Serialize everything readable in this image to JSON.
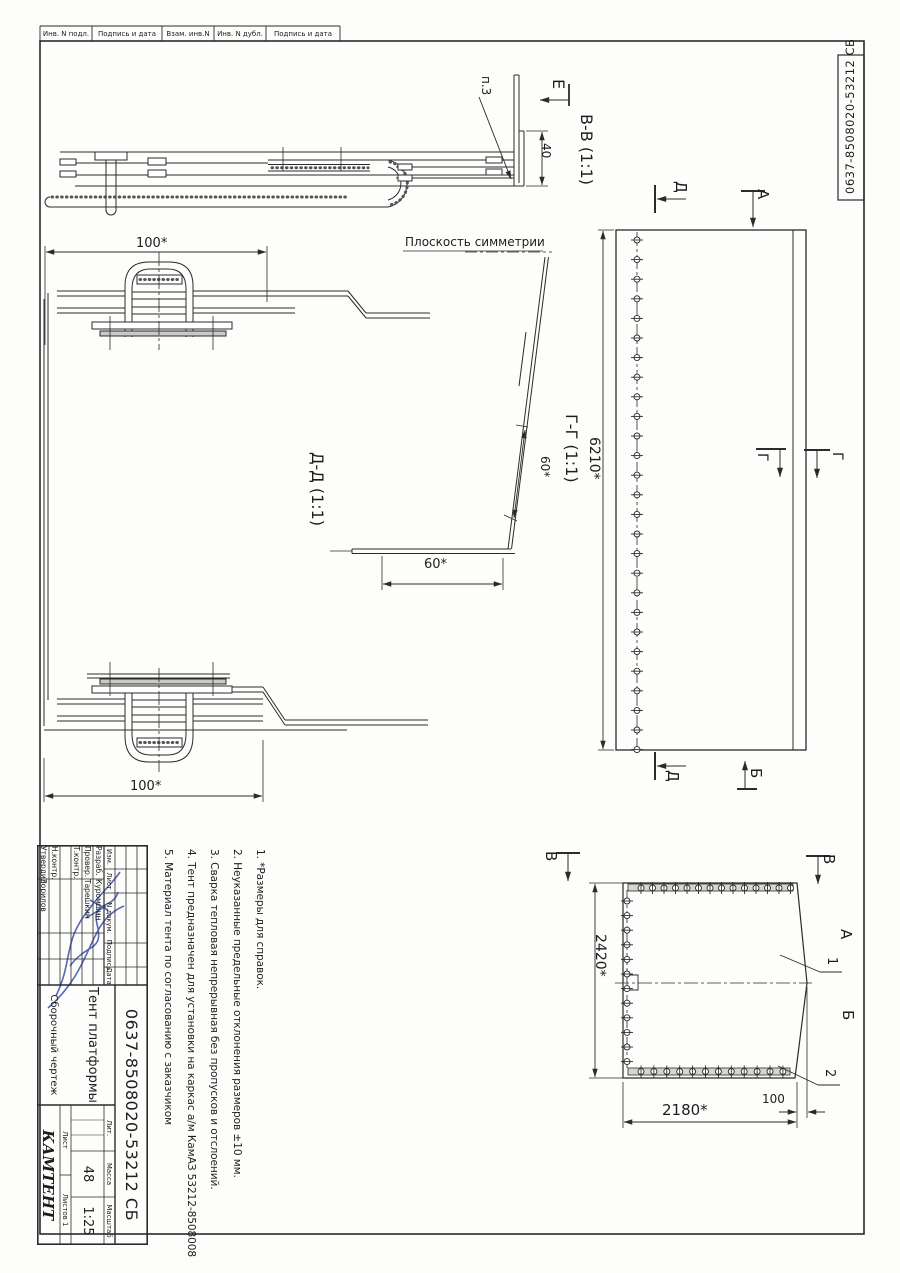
{
  "filing_strip": {
    "cells": [
      "Инв. N подл.",
      "Подпись и дата",
      "Взам. инв.N",
      "Инв. N дубл.",
      "Подпись и дата"
    ]
  },
  "corner_stamp": {
    "doc_number": "0637-8508020-53212  СБ"
  },
  "labels": {
    "symmetry": "Плоскость симметрии",
    "p3": "п.3",
    "bb": "В-В  (1:1)",
    "gg": "Г-Г  (1:1)",
    "dd": "Д-Д  (1:1)"
  },
  "dims": {
    "d40": "40",
    "d100_top": "100*",
    "d100_bot": "100*",
    "d60_g": "60*",
    "d60_d": "60*",
    "d6210": "6210*",
    "d2420": "2420*",
    "d2180": "2180*",
    "d100_rear": "100"
  },
  "marks": {
    "e_view": "Е",
    "d_top": "Д",
    "a_top": "А",
    "g_left": "Г",
    "g_right": "Г",
    "d_bottom": "Д",
    "b_bottom": "Б",
    "v_left": "В",
    "v_right": "В",
    "a_side": "А",
    "b_side": "Б",
    "c1": "1",
    "c2": "2"
  },
  "notes": [
    "1. *Размеры для справок.",
    "2. Неуказанные предельные отклонения размеров ±10 мм.",
    "3. Сварка тепловая непрерывная без пропусков и отслоений.",
    "4. Тент предназначен для установки на каркас а/м КамАЗ 53212-8508008",
    "5. Материал тента по согласованию с заказчиком"
  ],
  "title_block": {
    "change_header": {
      "izm": "Изм.",
      "list": "Лист",
      "doc": "N докум.",
      "sign": "Подпись",
      "date": "Дата"
    },
    "rows": [
      {
        "role": "Разраб.",
        "name": "Куромшин"
      },
      {
        "role": "Провер.",
        "name": "Тарешкин"
      },
      {
        "role": "Т.контр.",
        "name": ""
      },
      {
        "role": "Н.контр.",
        "name": ""
      },
      {
        "role": "Утвердил",
        "name": "Зорилов"
      }
    ],
    "doc_number": "0637-8508020-53212  СБ",
    "title": "Тент платформы",
    "doc_type": "Сборочный чертеж",
    "lit_label": "Лит.",
    "mass_label": "Масса",
    "scale_label": "Масштаб",
    "mass_value": "48",
    "scale_value": "1:25",
    "sheet_label": "Лист",
    "sheets_label": "Листов 1",
    "company": "КАМТЕНТ"
  }
}
